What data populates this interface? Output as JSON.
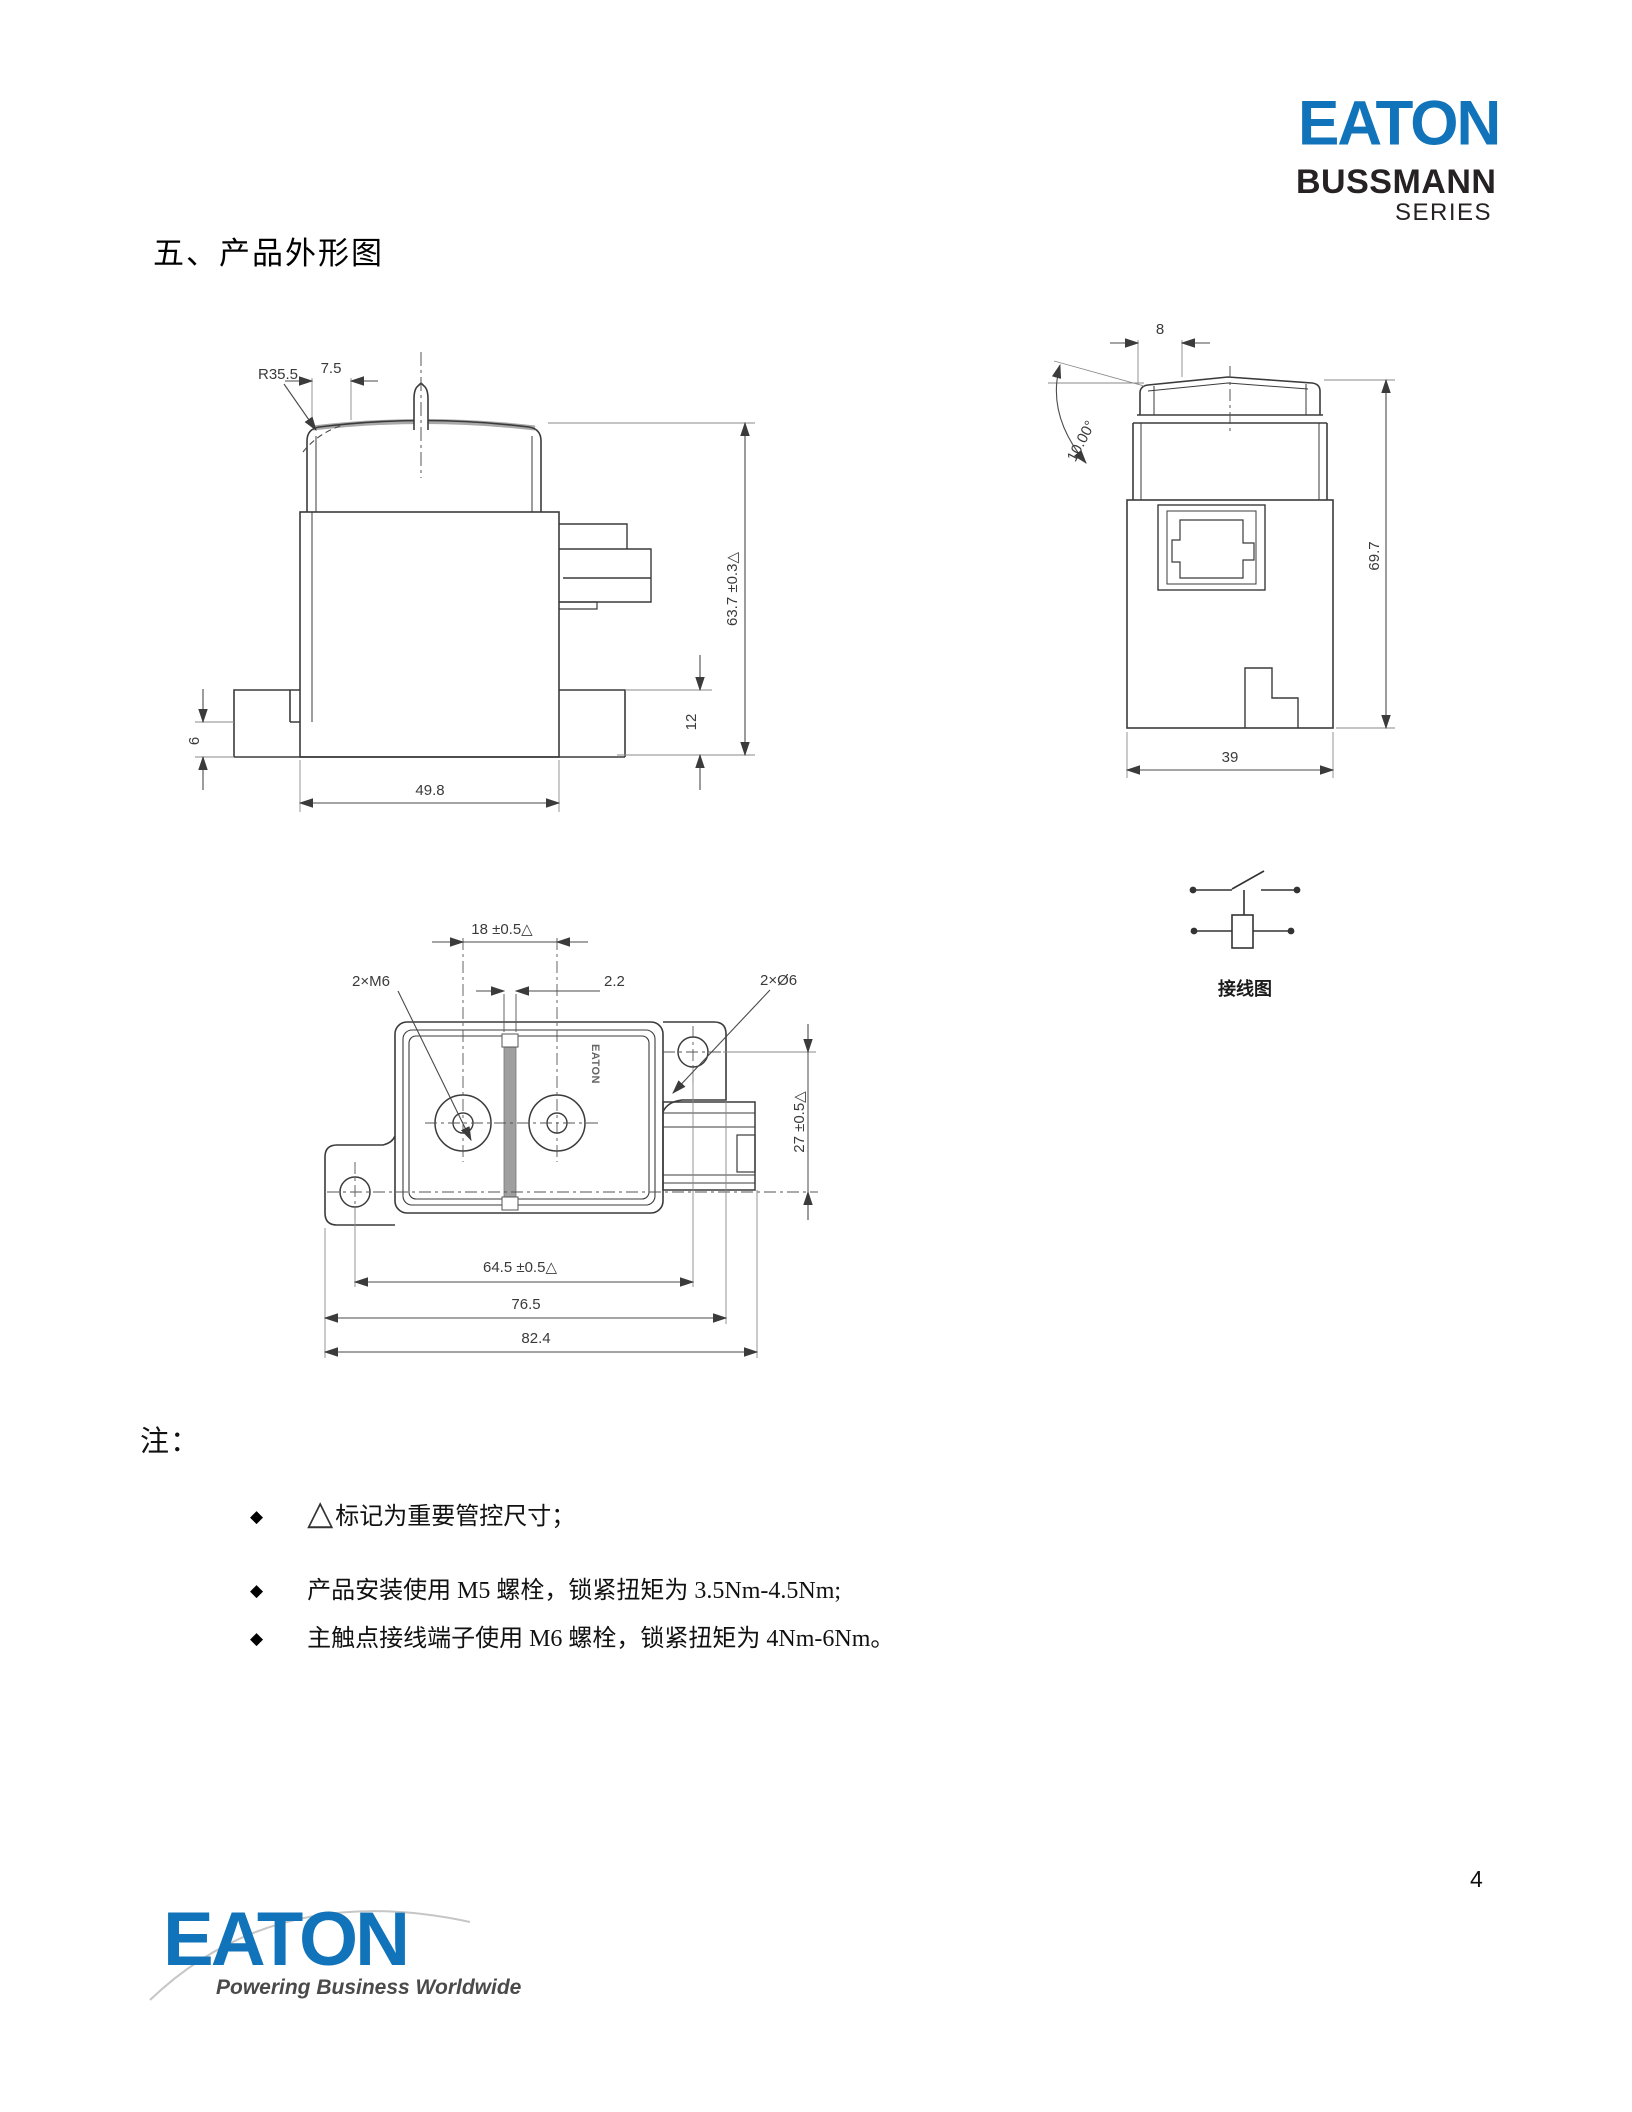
{
  "header": {
    "brand": "EATON",
    "series_line1": "BUSSMANN",
    "series_line2": "SERIES",
    "brand_color": "#1173b9"
  },
  "title": {
    "text": "五、产品外形图"
  },
  "front_view": {
    "dim_radius": "R35.5",
    "dim_top_width": "7.5",
    "dim_height": "63.7 ±0.3△",
    "dim_foot_height": "12",
    "dim_base_height": "6",
    "dim_width": "49.8"
  },
  "side_view": {
    "dim_top": "8",
    "dim_angle": "10.00°",
    "dim_height": "69.7",
    "dim_width": "39"
  },
  "top_view": {
    "dim_terminal_pitch": "18 ±0.5△",
    "dim_slot": "2.2",
    "dim_thread": "2×M6",
    "dim_holes": "2×Ø6",
    "dim_hole_pitch_v": "27 ±0.5△",
    "dim_hole_pitch_h": "64.5 ±0.5△",
    "dim_flange_span": "76.5",
    "dim_overall": "82.4",
    "marking": "EATON"
  },
  "wiring_diagram": {
    "label": "接线图"
  },
  "notes": {
    "heading": "注：",
    "bullet": "◆",
    "items": [
      {
        "symbol": "△",
        "text": "标记为重要管控尺寸；"
      },
      {
        "symbol": "",
        "text": "产品安装使用 M5 螺栓，锁紧扭矩为 3.5Nm-4.5Nm;"
      },
      {
        "symbol": "",
        "text": "主触点接线端子使用 M6 螺栓，锁紧扭矩为 4Nm-6Nm。"
      }
    ]
  },
  "footer": {
    "brand": "EATON",
    "tagline": "Powering Business Worldwide",
    "page_number": "4"
  }
}
